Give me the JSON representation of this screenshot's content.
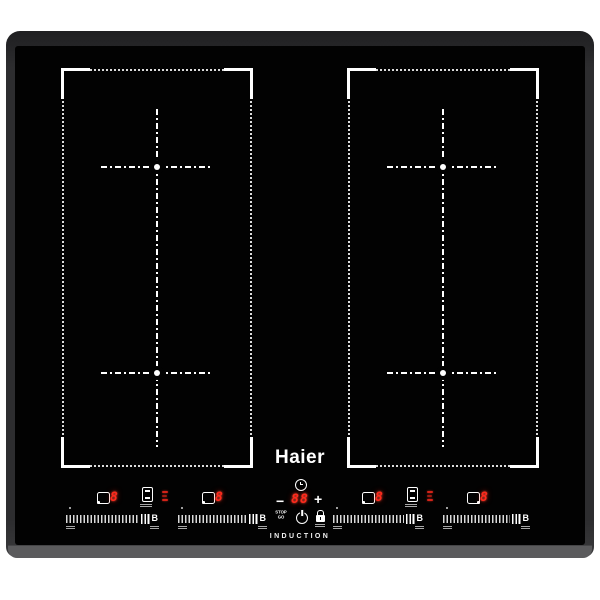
{
  "product": {
    "brand": "Haier",
    "type_label": "INDUCTION"
  },
  "timer": {
    "value": "88",
    "minus_label": "−",
    "plus_label": "+"
  },
  "zones": {
    "power_displays": [
      "8",
      "8",
      "8",
      "8"
    ],
    "boost_label": "B"
  },
  "pause_control": {
    "top": "STOP",
    "bottom": "GO"
  },
  "colors": {
    "digit_red": "#ff2a1c",
    "frame_gray": "#2d2d2f",
    "front_edge_gray": "#5b5b5d",
    "marking_white": "#ffffff",
    "glass_black": "#020202"
  }
}
